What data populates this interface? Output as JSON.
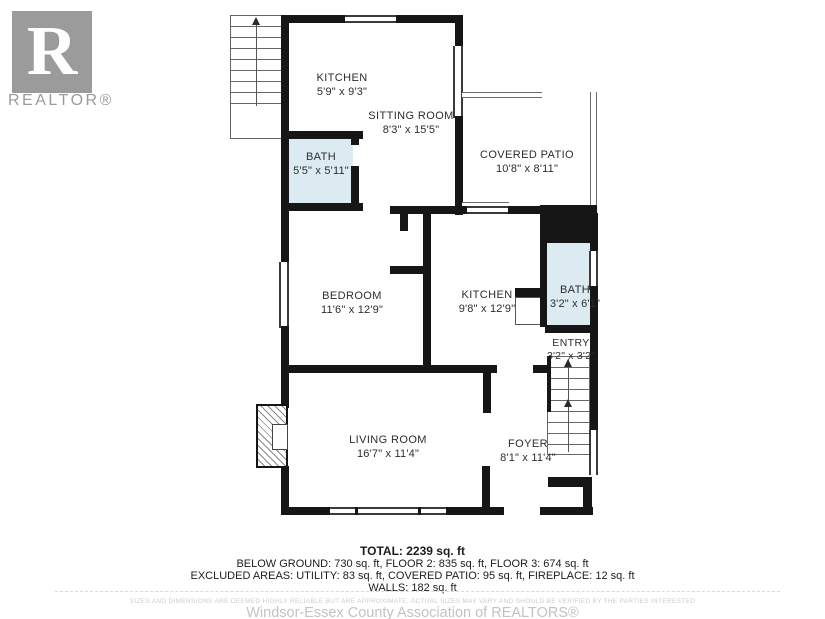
{
  "logo": {
    "letter": "R",
    "label": "REALTOR®"
  },
  "rooms": [
    {
      "id": "kitchen-upper",
      "name": "KITCHEN",
      "dims": "5'9\" x 9'3\""
    },
    {
      "id": "sitting-room",
      "name": "SITTING ROOM",
      "dims": "8'3\" x 15'5\""
    },
    {
      "id": "covered-patio",
      "name": "COVERED PATIO",
      "dims": "10'8\" x 8'11\""
    },
    {
      "id": "bath-upper",
      "name": "BATH",
      "dims": "5'5\" x 5'11\""
    },
    {
      "id": "bedroom",
      "name": "BEDROOM",
      "dims": "11'6\" x 12'9\""
    },
    {
      "id": "kitchen-main",
      "name": "KITCHEN",
      "dims": "9'8\" x 12'9\""
    },
    {
      "id": "bath-main",
      "name": "BATH",
      "dims": "3'2\" x 6'1\""
    },
    {
      "id": "entry",
      "name": "ENTRY",
      "dims": "3'2\" x 3'2\""
    },
    {
      "id": "living-room",
      "name": "LIVING ROOM",
      "dims": "16'7\" x 11'4\""
    },
    {
      "id": "foyer",
      "name": "FOYER",
      "dims": "8'1\" x 11'4\""
    }
  ],
  "summary": {
    "total": "TOTAL: 2239 sq. ft",
    "floors": "BELOW GROUND: 730 sq. ft, FLOOR 2: 835 sq. ft, FLOOR 3: 674 sq. ft",
    "excluded": "EXCLUDED AREAS: UTILITY: 83 sq. ft, COVERED PATIO: 95 sq. ft, FIREPLACE: 12 sq. ft",
    "walls": "WALLS: 182 sq. ft"
  },
  "disclaimer": "SIZES AND DIMENSIONS ARE DEEMED HIGHLY RELIABLE BUT ARE APPROXIMATE. ACTUAL SIZES MAY VARY AND SHOULD BE VERIFIED BY THE PARTIES INTERESTED",
  "association": "Windsor-Essex County Association of REALTORS®",
  "colors": {
    "bath_fill": "#dceaf2",
    "wall": "#161616",
    "logo_gray": "#9b9b9b"
  }
}
